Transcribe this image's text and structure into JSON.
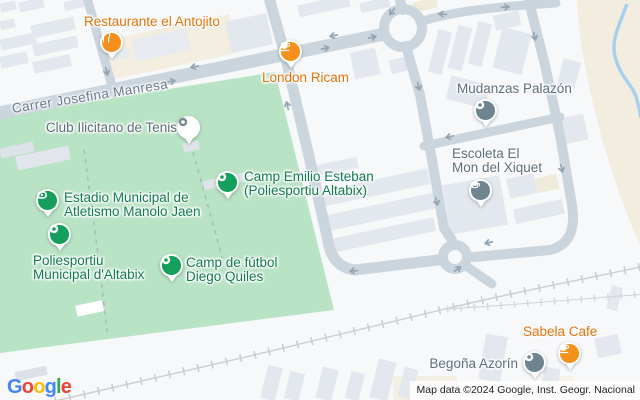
{
  "street": {
    "name": "Carrer Josefina Manresa"
  },
  "attribution": {
    "text": "Map data ©2024 Google, Inst. Geogr. Nacional"
  },
  "logo": {
    "word": "Google",
    "letters": [
      {
        "ch": "G",
        "color": "#4285F4"
      },
      {
        "ch": "o",
        "color": "#EA4335"
      },
      {
        "ch": "o",
        "color": "#FBBC05"
      },
      {
        "ch": "g",
        "color": "#4285F4"
      },
      {
        "ch": "l",
        "color": "#34A853"
      },
      {
        "ch": "e",
        "color": "#EA4335"
      }
    ]
  },
  "map_colors": {
    "road": "#cbd5de",
    "park": "#b9e3c5",
    "sand": "#f2edde",
    "water": "#a6d0ef",
    "railway": "#c9cdd6",
    "building": "#e3e7ee",
    "background": "#f7f8fa"
  },
  "pois": [
    {
      "label": "Restaurante el Antojito",
      "category": "restaurant",
      "pin_color": "#f5901d",
      "label_color": "#e8710a"
    },
    {
      "label": "London Ricam",
      "category": "cafe",
      "pin_color": "#f5901d",
      "label_color": "#e8710a"
    },
    {
      "label": "Mudanzas Palazón",
      "category": "business",
      "pin_color": "#6e8491",
      "label_color": "#5d6f7b"
    },
    {
      "label": "Club Ilicitano de Tenis",
      "category": "tennis-club",
      "pin_color": "#ffffff",
      "label_color": "#5d6f7b"
    },
    {
      "lines": [
        "Camp Emilio Esteban",
        "(Poliesportiu Altabix)"
      ],
      "category": "sports-field",
      "pin_color": "#14a05c",
      "label_color": "#0f7c4f"
    },
    {
      "lines": [
        "Estadio Municipal de",
        "Atletismo Manolo Jaen"
      ],
      "category": "stadium",
      "pin_color": "#14a05c",
      "label_color": "#0f7c4f"
    },
    {
      "lines": [
        "Escoleta El",
        "Mon del Xiquet"
      ],
      "category": "school",
      "pin_color": "#6e8491",
      "label_color": "#5d6f7b"
    },
    {
      "lines": [
        "Poliesportiu",
        "Municipal d'Altabix"
      ],
      "category": "sports-field",
      "pin_color": "#14a05c",
      "label_color": "#0f7c4f"
    },
    {
      "lines": [
        "Camp de fútbol",
        "Diego Quiles"
      ],
      "category": "sports-field",
      "pin_color": "#14a05c",
      "label_color": "#0f7c4f"
    },
    {
      "label": "Sabela Cafe",
      "category": "cafe",
      "pin_color": "#f5901d",
      "label_color": "#e8710a"
    },
    {
      "label": "Begoña Azorín",
      "category": "business",
      "pin_color": "#6e8491",
      "label_color": "#5d6f7b"
    }
  ]
}
